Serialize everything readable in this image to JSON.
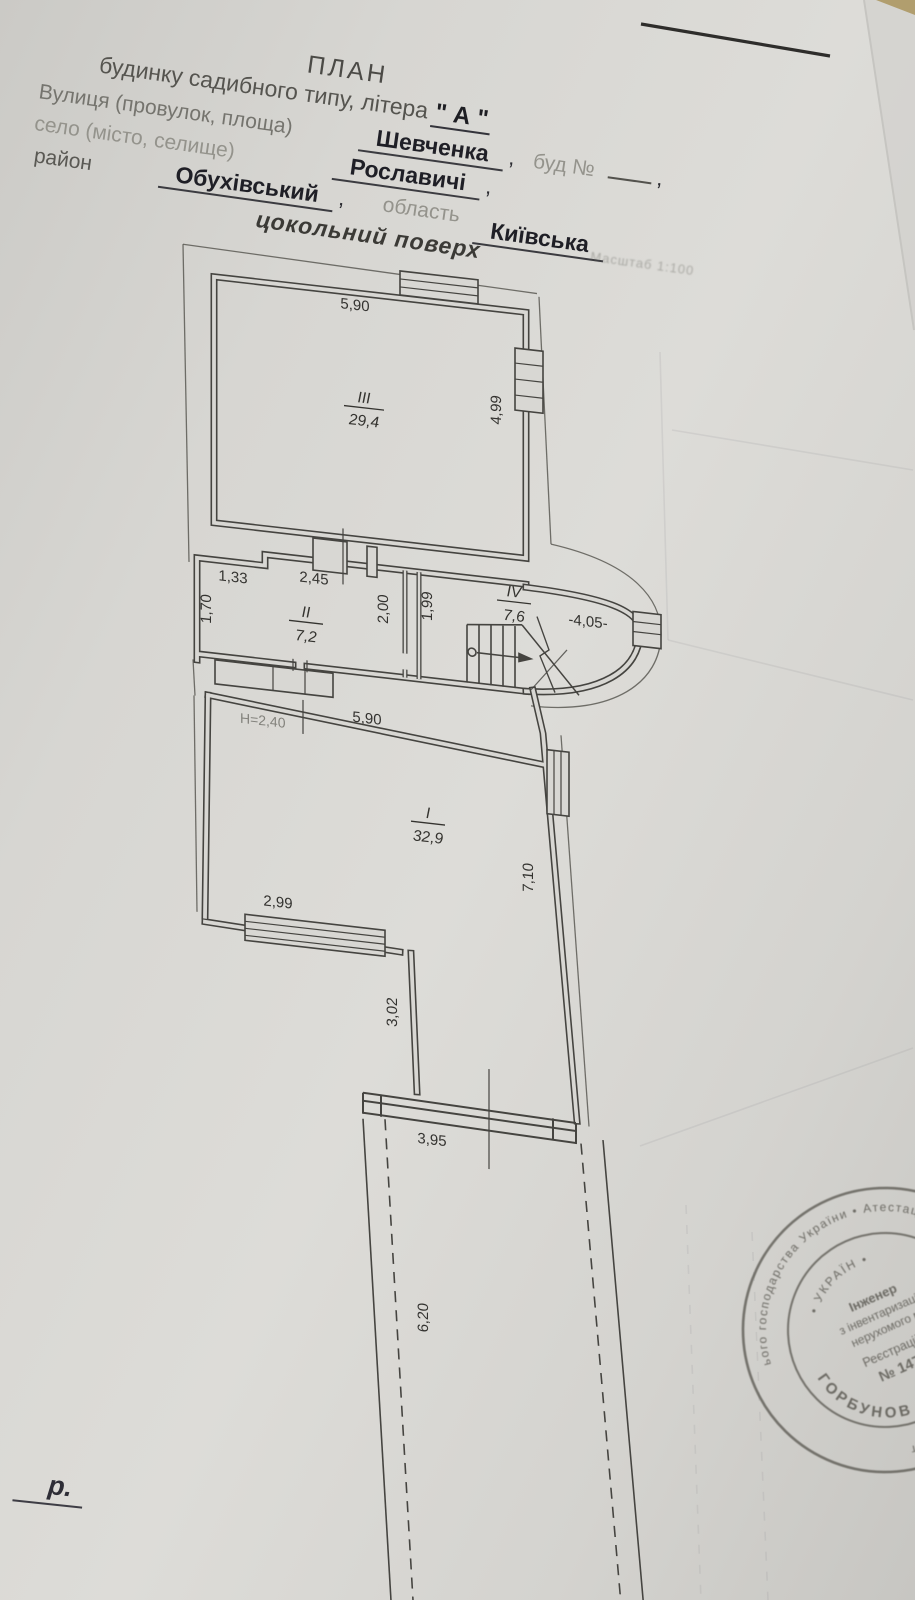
{
  "header": {
    "title": "ПЛАН",
    "subtitle": "будинку садибного типу, літера",
    "letter": "\" А \"",
    "street_label": "Вулиця (провулок, площа)",
    "street_value": "Шевченка",
    "comma": ",",
    "bud_label": "буд №",
    "village_label": "село (місто, селище)",
    "village_value": "Рославичі",
    "district_label": "район",
    "district_value": "Обухівський",
    "oblast_label": "область",
    "oblast_value": "Київська"
  },
  "plan": {
    "floor_label": "цокольний поверх",
    "scale_note": "Масштаб 1:100",
    "rooms": [
      {
        "number": "III",
        "area": "29,4"
      },
      {
        "number": "II",
        "area": "7,2"
      },
      {
        "number": "IV",
        "area": "7,6"
      },
      {
        "number": "I",
        "area": "32,9"
      }
    ],
    "dims": {
      "top_width": "5,90",
      "right_height": "4,99",
      "d133": "1,33",
      "d245": "2,45",
      "d170": "1,70",
      "d200": "2,00",
      "d199": "1,99",
      "level": "-4,05-",
      "ceiling_height": "H=2,40",
      "mid_width": "5,90",
      "d299": "2,99",
      "d710": "7,10",
      "d302": "3,02",
      "d395": "3,95",
      "d620": "6,20"
    }
  },
  "stamp": {
    "ring_outer": "ього господарства України  •  Атестаційна архітектурно-буд  •  Кваліфікаційний серт",
    "ring_name": "ГОРБУНОВ ВІКТОР М",
    "ring_country": "• УКРАЇН •",
    "line1": "Інженер",
    "line2": "з інвентаризації",
    "line3": "нерухомого м",
    "line4": "Реєстраційн",
    "line5": "№ 1474"
  },
  "footer": {
    "year_mark": "р."
  }
}
